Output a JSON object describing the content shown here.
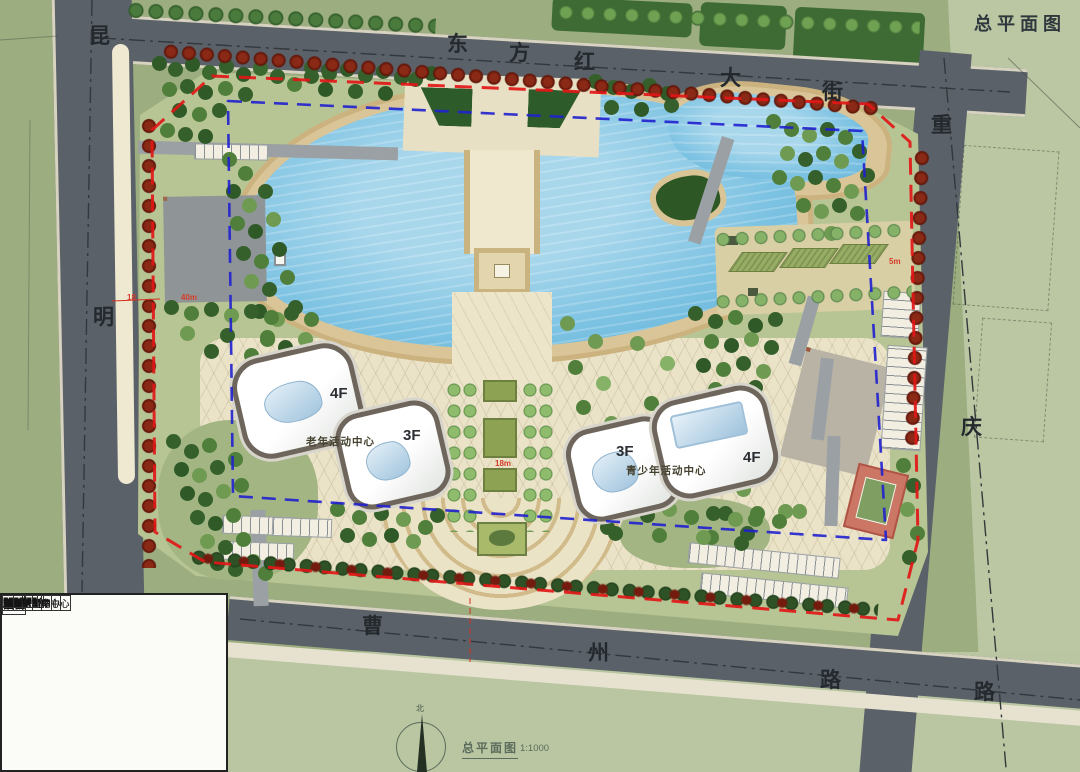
{
  "corner_title": "总平面图",
  "caption": {
    "title": "总平面图",
    "scale": "1:1000"
  },
  "compass": {
    "north": "北"
  },
  "streets": {
    "top": [
      "东",
      "方",
      "红",
      "大",
      "街"
    ],
    "left": [
      "昆",
      "明"
    ],
    "right": [
      "重",
      "庆",
      "路"
    ],
    "bottom": [
      "曹",
      "州",
      "路"
    ]
  },
  "site_labels": {
    "senior_center": "老年活动中心",
    "senior_floor_a": "4F",
    "senior_floor_b": "3F",
    "youth_center": "青少年活动中心",
    "youth_floor_a": "3F",
    "youth_floor_b": "4F"
  },
  "dimensions": {
    "road_width": "18",
    "court": "40m",
    "axis": "18m",
    "edge": "5m"
  },
  "area_table": {
    "headers": {
      "item": "项目",
      "area": "面积",
      "unit": "单位"
    },
    "group_label_1": "其中",
    "group_label_2": "其中",
    "rows": [
      {
        "item": "总建筑面积",
        "area": "31563.14",
        "unit": "㎡"
      },
      {
        "item": "青少年活动中心",
        "area": "14553.74",
        "unit": "㎡"
      },
      {
        "item": "图书馆",
        "area": "5658",
        "unit": "㎡"
      },
      {
        "item": "青少年活动中心",
        "area": "7214.11",
        "unit": "㎡"
      },
      {
        "item": "公共空间",
        "area": "336.44",
        "unit": "㎡"
      },
      {
        "item": "半地下车库",
        "area": "1345.19",
        "unit": "㎡"
      },
      {
        "item": "老年活动中心",
        "area": "17009.4",
        "unit": "㎡"
      },
      {
        "item": "档案馆",
        "area": "5129.94",
        "unit": "㎡"
      },
      {
        "item": "老年活动中心",
        "area": "7193.71",
        "unit": "㎡"
      },
      {
        "item": "公共空间",
        "area": "244.08",
        "unit": "㎡"
      },
      {
        "item": "商业",
        "area": "492.61",
        "unit": "㎡"
      },
      {
        "item": "半地下车库",
        "area": "3949.06",
        "unit": "㎡"
      }
    ]
  },
  "colors": {
    "boundary_red": "#e11717",
    "setback_blue": "#2020cf",
    "road": "#5b6168",
    "water": "#7cc2e2",
    "sand": "#d9c598"
  }
}
